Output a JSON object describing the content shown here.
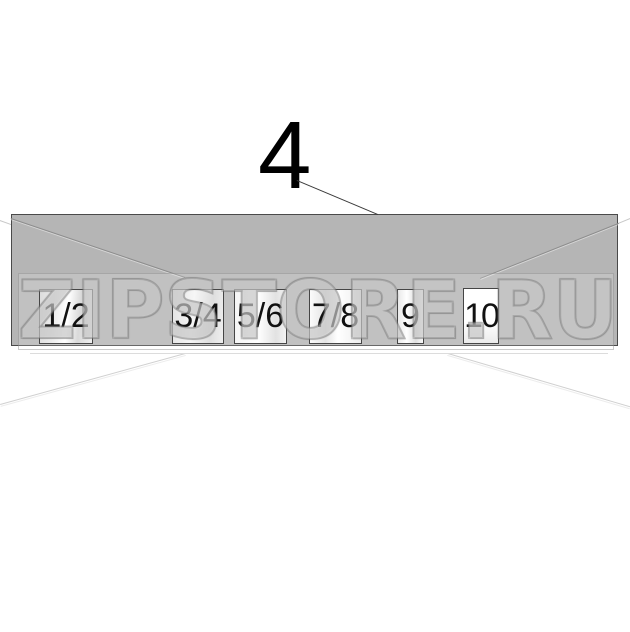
{
  "figure": {
    "callout_label": "4",
    "watermark": "ZIPSTORE.RU",
    "boxes": [
      {
        "label": "1/2"
      },
      {
        "label": "3/4"
      },
      {
        "label": "5/6"
      },
      {
        "label": "7/8"
      },
      {
        "label": "9"
      },
      {
        "label": "10"
      }
    ],
    "colors": {
      "panel_fill": "#b5b5b5",
      "panel_border": "#4a4a4a",
      "box_border": "#454545",
      "label_text": "#111111",
      "construction_line": "#8d8d8d",
      "faint_line": "#d0d0d0",
      "callout_color": "#000000"
    }
  }
}
